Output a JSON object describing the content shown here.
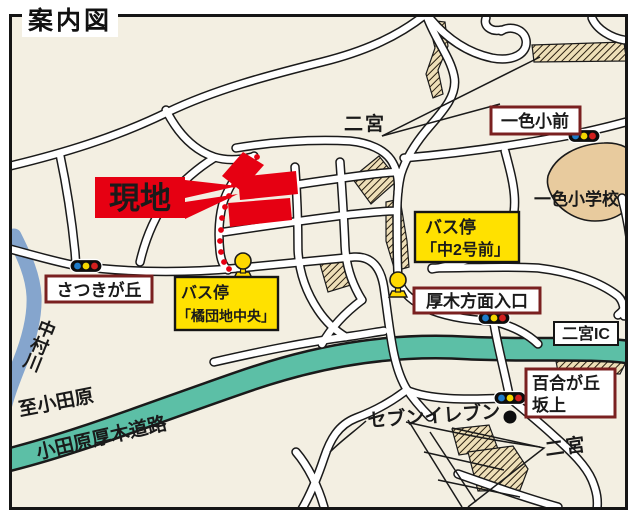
{
  "title": "案内図",
  "labels": {
    "site": "現地",
    "ninomiya_top": "二宮",
    "isshiki_sho_mae": "一色小前",
    "isshiki_elementary_school": "一色小学校",
    "satsukigaoka": "さつきが丘",
    "nakamura_river": "中村川",
    "to_odawara": "至小田原",
    "odawara_atsugi_road": "小田原厚木道路",
    "atsugi_entrance": "厚木方面入口",
    "ninomiya_ic": "二宮IC",
    "yurigaoka_line1": "百合が丘",
    "yurigaoka_line2": "坂上",
    "seven_eleven": "セブンイレブン",
    "ninomiya_bottom": "二宮"
  },
  "bus_stops": {
    "tachibana_danchi_chuo": {
      "prefix": "バス停",
      "name": "「橘団地中央」"
    },
    "naka_2_go_mae": {
      "prefix": "バス停",
      "name": "「中2号前」"
    }
  },
  "icons": {
    "traffic_light": "traffic-light-icon",
    "bus_stop": "bus-stop-pole-icon",
    "store_dot": "store-location-dot"
  },
  "colors": {
    "site_red": "#e60012",
    "bus_label_yellow": "#ffe100",
    "highway_teal": "#5cbfa6",
    "river_blue": "#85a5cd",
    "map_cream": "#f3efe2",
    "box_maroon": "#7a2020",
    "building_tan": "#e8cb9e",
    "signal_blue": "#1f7cc9",
    "signal_yellow": "#f3d600",
    "signal_red": "#d2201f"
  }
}
